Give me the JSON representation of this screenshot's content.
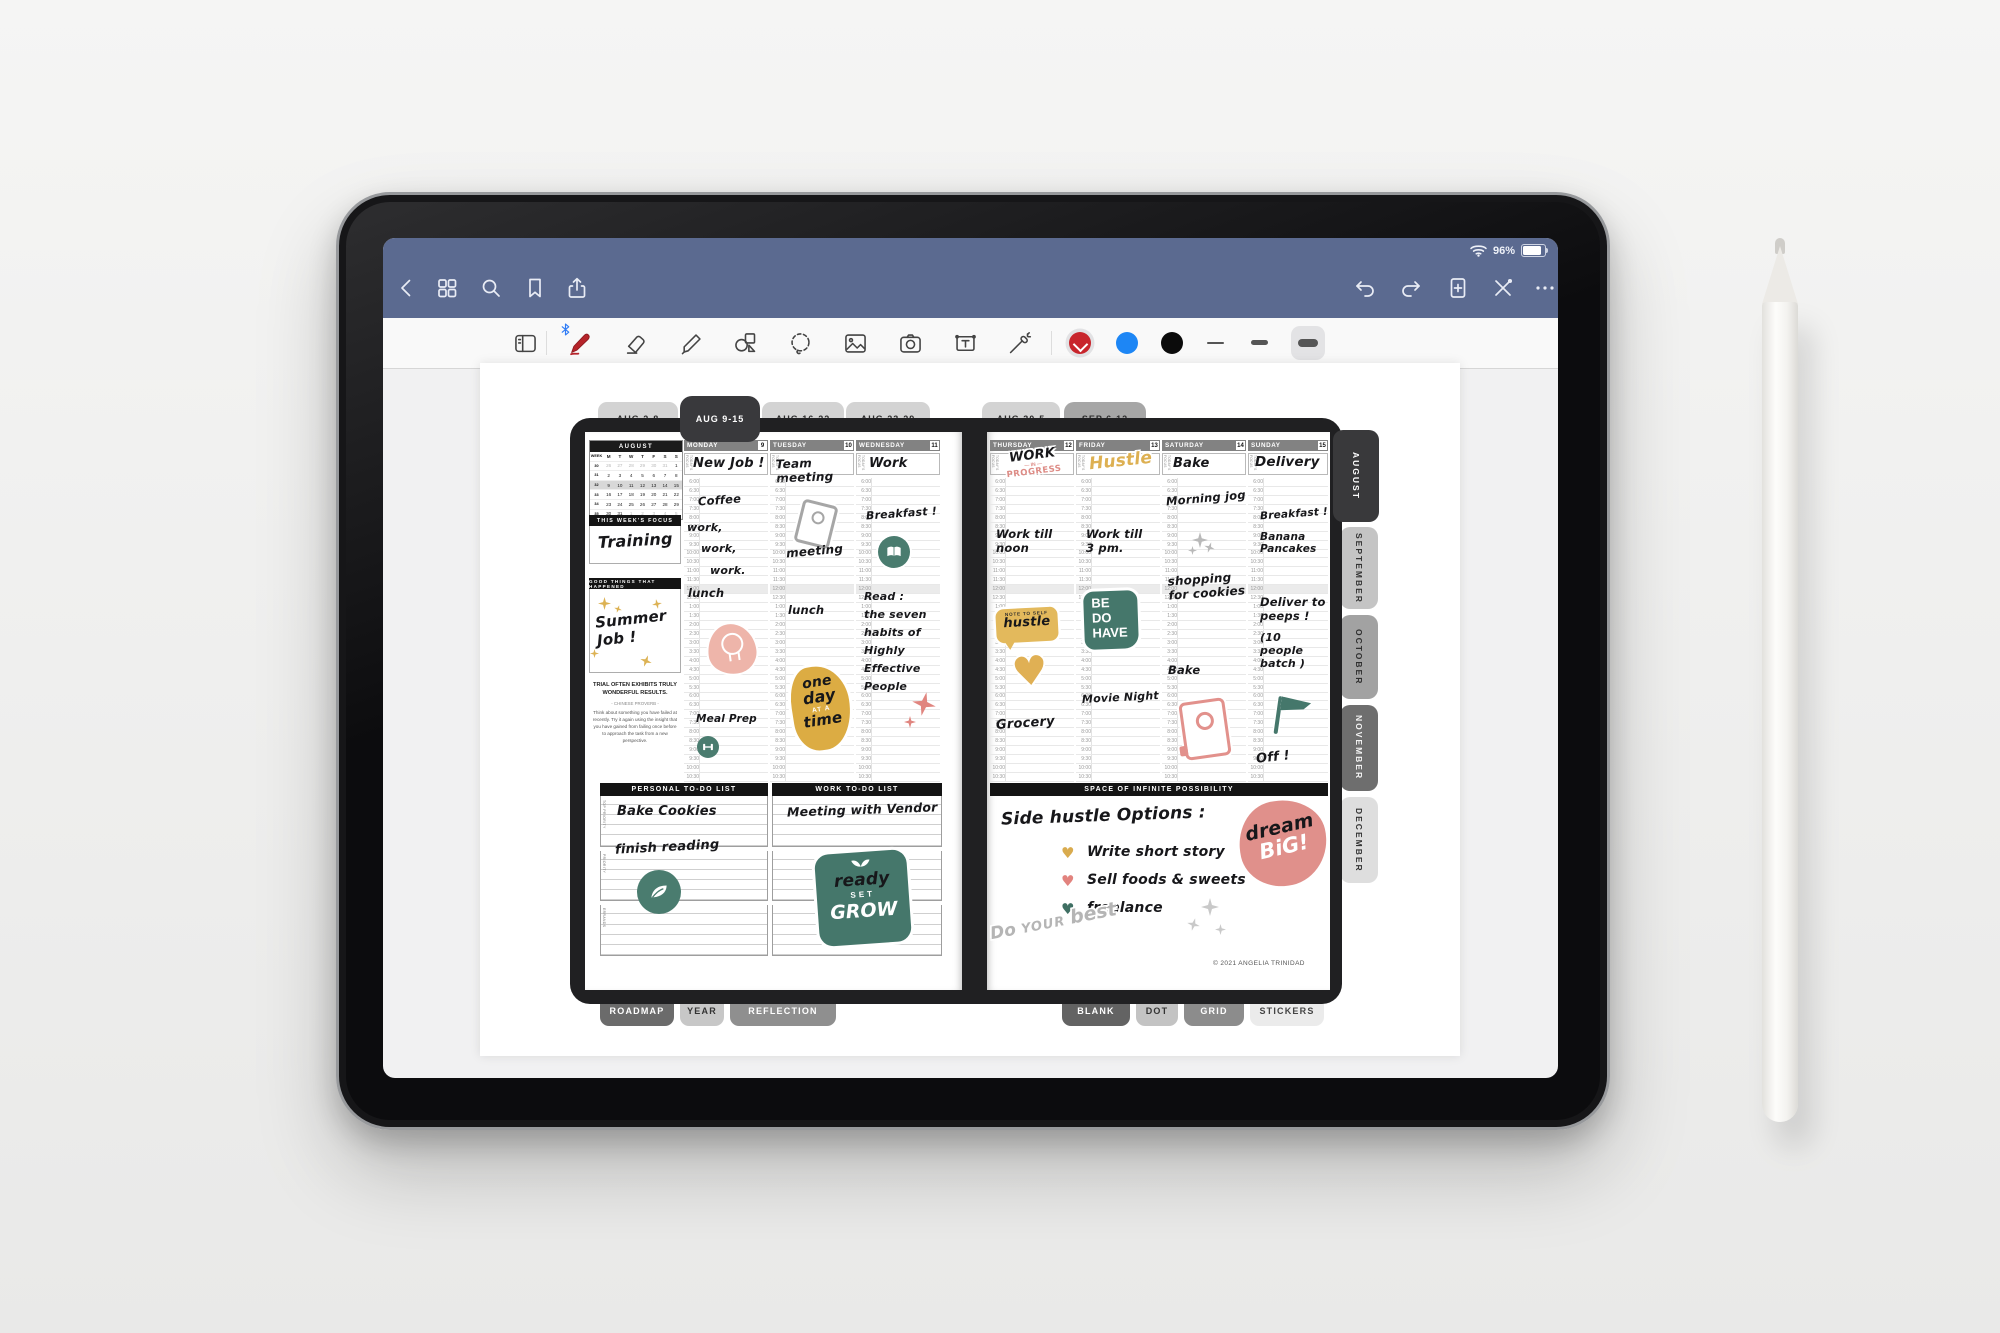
{
  "status_bar": {
    "battery_percent": "96%"
  },
  "tool_bar": {
    "colors": {
      "red": "#c8252c",
      "blue": "#1d86f5",
      "black": "#0b0b0b"
    },
    "selected_tool": "pen",
    "selected_color": "red",
    "selected_stroke": "thick"
  },
  "week_tabs": {
    "items": [
      {
        "label": "AUG 2-8"
      },
      {
        "label": "AUG 9-15"
      },
      {
        "label": "AUG 16-22"
      },
      {
        "label": "AUG 23-29"
      },
      {
        "label": "AUG 30-5"
      },
      {
        "label": "SEP 6-12"
      }
    ]
  },
  "month_tabs": {
    "items": [
      {
        "label": "AUGUST"
      },
      {
        "label": "SEPTEMBER"
      },
      {
        "label": "OCTOBER"
      },
      {
        "label": "NOVEMBER"
      },
      {
        "label": "DECEMBER"
      }
    ]
  },
  "bottom_tabs": {
    "left": [
      {
        "label": "ROADMAP"
      },
      {
        "label": "YEAR"
      },
      {
        "label": "REFLECTION"
      }
    ],
    "right": [
      {
        "label": "BLANK"
      },
      {
        "label": "DOT"
      },
      {
        "label": "GRID"
      },
      {
        "label": "STICKERS"
      }
    ]
  },
  "sidebar": {
    "calendar": {
      "title": "AUGUST",
      "week_col": "WEEK",
      "day_headers": [
        "M",
        "T",
        "W",
        "T",
        "F",
        "S",
        "S"
      ],
      "weeks": [
        {
          "num": "30",
          "days": [
            "26",
            "27",
            "28",
            "29",
            "30",
            "31",
            "1"
          ],
          "muted": [
            true,
            true,
            true,
            true,
            true,
            true,
            false
          ],
          "current": false
        },
        {
          "num": "31",
          "days": [
            "2",
            "3",
            "4",
            "5",
            "6",
            "7",
            "8"
          ],
          "muted": [
            false,
            false,
            false,
            false,
            false,
            false,
            false
          ],
          "current": false
        },
        {
          "num": "32",
          "days": [
            "9",
            "10",
            "11",
            "12",
            "13",
            "14",
            "15"
          ],
          "muted": [
            false,
            false,
            false,
            false,
            false,
            false,
            false
          ],
          "current": true
        },
        {
          "num": "33",
          "days": [
            "16",
            "17",
            "18",
            "19",
            "20",
            "21",
            "22"
          ],
          "muted": [
            false,
            false,
            false,
            false,
            false,
            false,
            false
          ],
          "current": false
        },
        {
          "num": "34",
          "days": [
            "23",
            "24",
            "25",
            "26",
            "27",
            "28",
            "29"
          ],
          "muted": [
            false,
            false,
            false,
            false,
            false,
            false,
            false
          ],
          "current": false
        },
        {
          "num": "35",
          "days": [
            "30",
            "31",
            "1",
            "2",
            "3",
            "4",
            "5"
          ],
          "muted": [
            false,
            false,
            true,
            true,
            true,
            true,
            true
          ],
          "current": false
        }
      ]
    },
    "focus_banner": "THIS WEEK'S FOCUS",
    "focus_value": "Training",
    "good_banner": "GOOD THINGS THAT HAPPENED",
    "good_value": "Summer\nJob !",
    "quote_title": "TRIAL OFTEN EXHIBITS TRULY WONDERFUL RESULTS.",
    "quote_attr": "- CHINESE PROVERB -",
    "quote_body": "Think about something you have failed at recently. Try it again using the insight that you have gained from failing once before to approach the task from a new perspective."
  },
  "planner": {
    "focus_label": "TODAY'S FOCUS",
    "time_slots": [
      "6:00",
      "6:30",
      "7:00",
      "7:30",
      "8:00",
      "8:30",
      "9:00",
      "9:30",
      "10:00",
      "10:30",
      "11:00",
      "11:30",
      "12:00",
      "12:30",
      "1:00",
      "1:30",
      "2:00",
      "2:30",
      "3:00",
      "3:30",
      "4:00",
      "4:30",
      "5:00",
      "5:30",
      "6:00",
      "6:30",
      "7:00",
      "7:30",
      "8:00",
      "8:30",
      "9:00",
      "9:30",
      "10:00",
      "10:30"
    ],
    "days": [
      {
        "name": "MONDAY",
        "date": "9"
      },
      {
        "name": "TUESDAY",
        "date": "10"
      },
      {
        "name": "WEDNESDAY",
        "date": "11"
      },
      {
        "name": "THURSDAY",
        "date": "12"
      },
      {
        "name": "FRIDAY",
        "date": "13"
      },
      {
        "name": "SATURDAY",
        "date": "14"
      },
      {
        "name": "SUNDAY",
        "date": "15"
      }
    ],
    "entries": {
      "mon_focus": "New Job !",
      "mon_coffee": "Coffee",
      "mon_work1": "work,",
      "mon_work2": "work,",
      "mon_work3": "work.",
      "mon_lunch": "lunch",
      "mon_meal_prep": "Meal Prep",
      "tue_focus": "Team meeting",
      "tue_meeting": "meeting",
      "tue_lunch": "lunch",
      "wed_focus": "Work",
      "wed_breakfast": "Breakfast !",
      "wed_read": "Read :\nthe seven\nhabits of\nHighly\nEffective\nPeople",
      "thu_work": "Work till\nnoon",
      "thu_grocery": "Grocery",
      "fri_work": "Work till\n3 pm.",
      "fri_movie": "Movie Night",
      "sat_focus": "Bake",
      "sat_jog": "Morning jog",
      "sat_shopping": "shopping\nfor cookies",
      "sat_bake": "Bake",
      "sun_focus": "Delivery",
      "sun_breakfast": "Breakfast !",
      "sun_pancakes": "Banana\n   Pancakes",
      "sun_deliver": "Deliver to\npeeps !",
      "sun_batch": "(10 people\nbatch )",
      "sun_off": "Off !"
    },
    "stickers": {
      "work_in_progress": {
        "l1": "WORK",
        "l2": "— IN —",
        "l3": "PROGRESS"
      },
      "hustle_focus": "Hustle",
      "note_to_self": {
        "label": "NOTE TO SELF",
        "text": "hustle"
      },
      "one_day": {
        "l1": "one",
        "l2": "day",
        "l3": "AT A",
        "l4": "time"
      },
      "be_do_have": {
        "l1": "BE",
        "l2": "DO",
        "l3": "HAVE"
      },
      "dream_big": {
        "l1": "dream",
        "l2": "BiG!"
      },
      "do_your_best": {
        "l1": "Do",
        "l2": "YOUR",
        "l3": "best"
      },
      "ready_set_grow": {
        "l1": "ready",
        "l2": "SET",
        "l3": "GROW"
      }
    }
  },
  "todo": {
    "personal_banner": "PERSONAL TO-DO LIST",
    "work_banner": "WORK TO-DO LIST",
    "sections": [
      "TOP PRIORITY",
      "PRIORITY",
      "ERRANDS"
    ],
    "personal_1": "Bake Cookies",
    "personal_2": "finish reading",
    "work_1": "Meeting with Vendor"
  },
  "possibility": {
    "banner": "SPACE OF INFINITE POSSIBILITY",
    "title": "Side hustle Options :",
    "items": [
      {
        "text": "Write short story"
      },
      {
        "text": "Sell foods & sweets"
      },
      {
        "text": "freelance"
      }
    ]
  },
  "copyright": "© 2021 ANGELIA TRINIDAD"
}
